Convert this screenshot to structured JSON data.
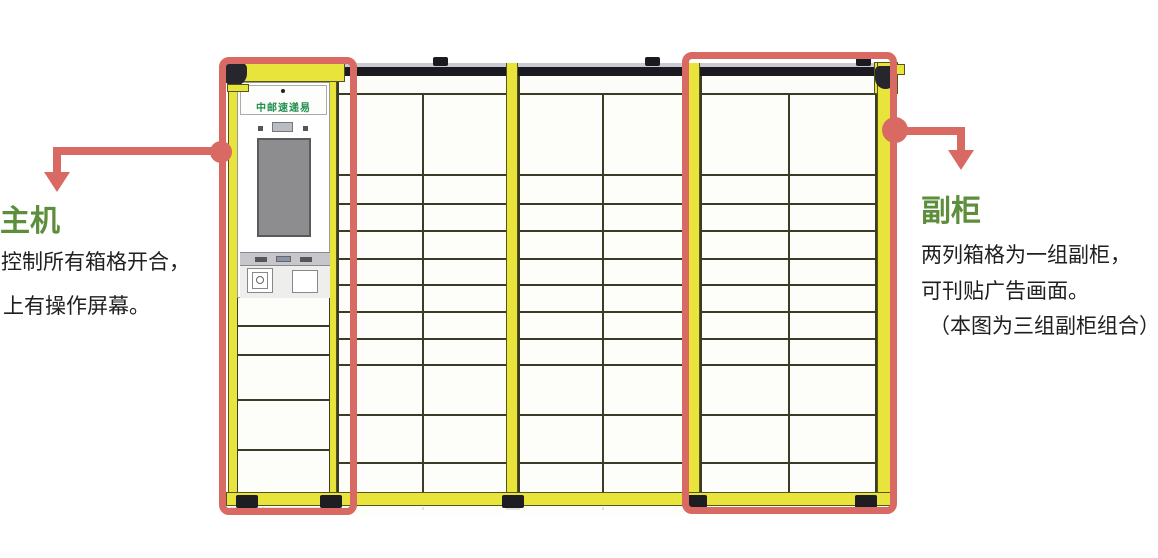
{
  "labels": {
    "main_unit": {
      "heading": "主机",
      "line1": "控制所有箱格开合，",
      "line2": "上有操作屏幕。"
    },
    "aux": {
      "heading": "副柜",
      "line1": "两列箱格为一组副柜，",
      "line2": "可刊贴广告画面。",
      "line3": "（本图为三组副柜组合）"
    }
  },
  "cabinet": {
    "brand": "中邮速递易",
    "group_count": 3,
    "columns_per_group": 2
  },
  "colors": {
    "bg": "#ffffff",
    "yellow": "#e9e43c",
    "olive": "#56551e",
    "line": "#3c3b26",
    "red": "#d96a63",
    "green": "#5d8e3c",
    "brand": "#1f8f4e",
    "rail": "#1a1a20",
    "screen": "#8d8d8f",
    "ink": "#1f1f1f"
  }
}
